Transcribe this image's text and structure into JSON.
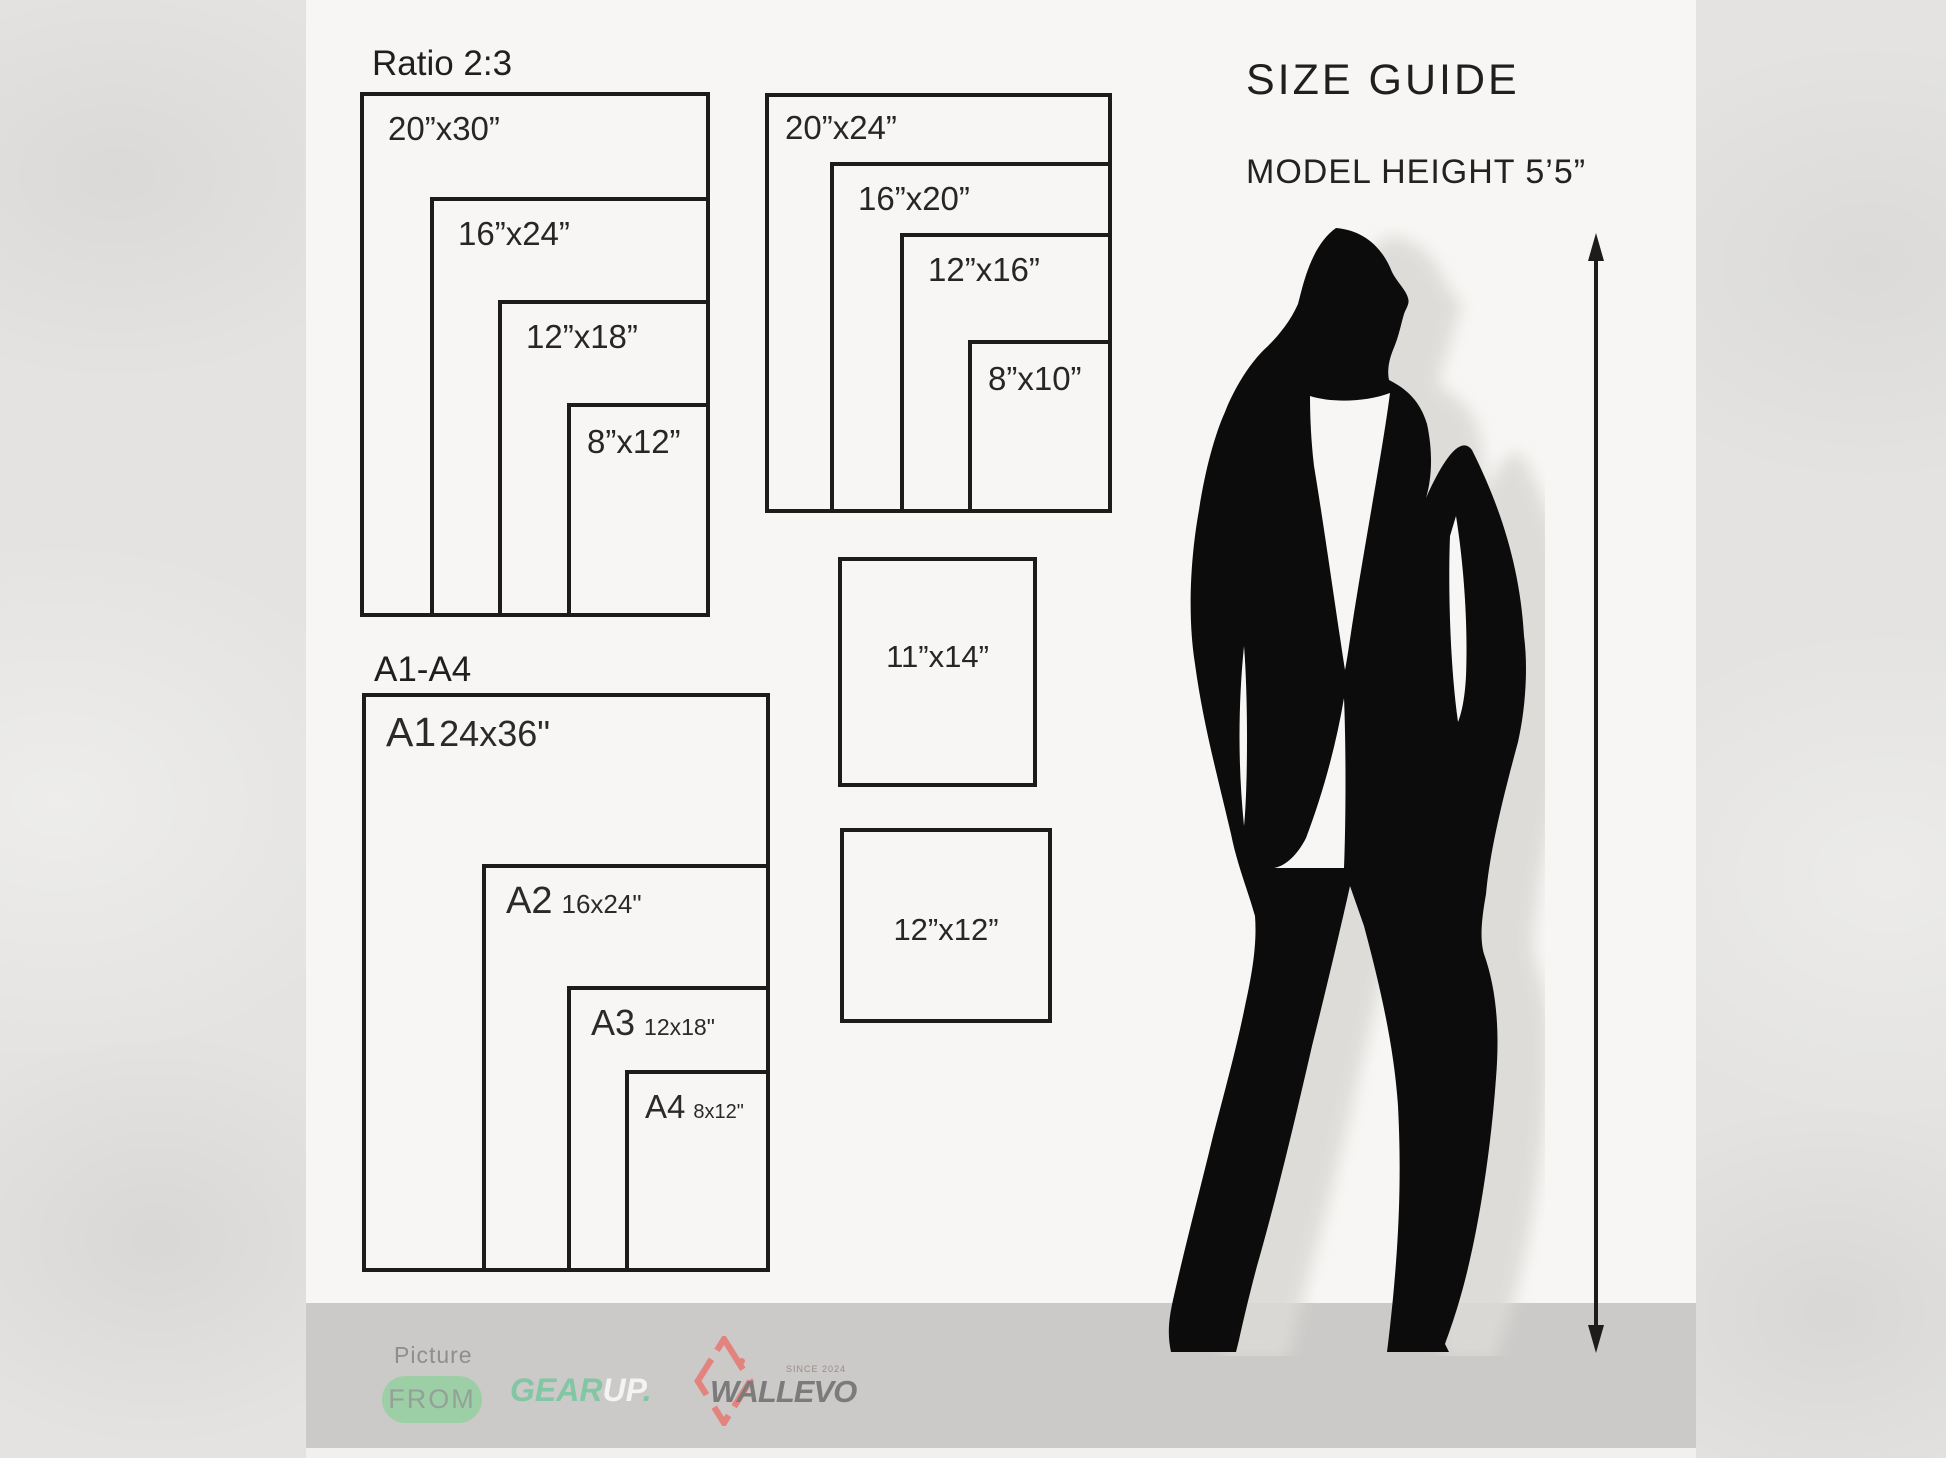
{
  "ratio_group": {
    "title": "Ratio 2:3",
    "sizes": [
      "20”x30”",
      "16”x24”",
      "12”x18”",
      "8”x12”"
    ]
  },
  "standard_group": {
    "sizes": [
      "20”x24”",
      "16”x20”",
      "12”x16”",
      "8”x10”"
    ]
  },
  "a_group": {
    "title": "A1-A4",
    "items": [
      {
        "code": "A1",
        "size": "24x36\""
      },
      {
        "code": "A2",
        "size": "16x24\""
      },
      {
        "code": "A3",
        "size": "12x18\""
      },
      {
        "code": "A4",
        "size": "8x12\""
      }
    ]
  },
  "solo_rects": {
    "r1114": "11”x14”",
    "r1212": "12”x12”"
  },
  "guide": {
    "title": "SIZE GUIDE",
    "model_height": "MODEL HEIGHT 5’5”"
  },
  "footer": {
    "picture": "Picture",
    "from": "FROM",
    "gear": "GEAR",
    "up": "UP",
    "dot": ".",
    "wallevo": "WALLEVO",
    "since": "SINCE 2024"
  },
  "colors": {
    "ink": "#1c1c1c",
    "panel": "#f7f6f4",
    "band": "#cbcac8",
    "pill_green": "#9ccfa5",
    "gear_teal": "#82c6a3",
    "wallevo_red": "#e2837e",
    "wallevo_gray": "#7b7b7b",
    "silhouette": "#0c0c0c"
  }
}
